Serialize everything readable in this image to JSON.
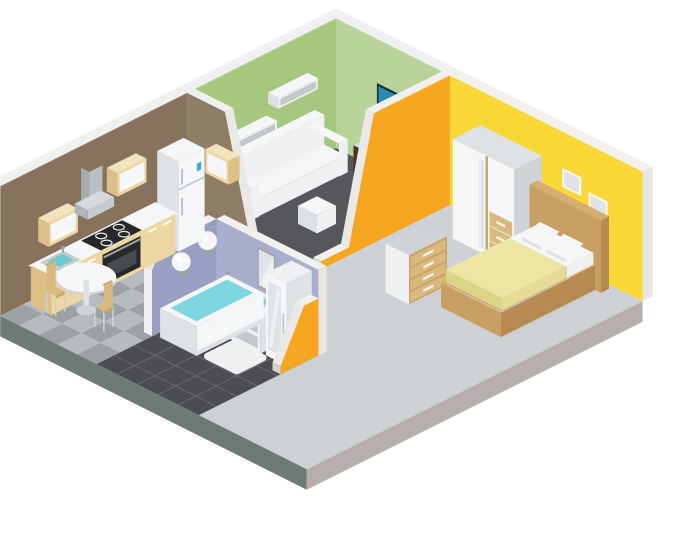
{
  "title": "Isometric cutaway illustration of a one-bedroom apartment with kitchen, living room, bedroom and bathroom",
  "rooms": [
    {
      "name": "kitchen",
      "wall_color": "#87725e",
      "floor_color": "#9ba1a5",
      "furniture": [
        "wall cabinets",
        "range hood",
        "cooktop",
        "oven",
        "kitchen sink",
        "refrigerator",
        "counter cabinets",
        "round dining table",
        "two chairs"
      ]
    },
    {
      "name": "living-room",
      "wall_color": "#a5c77e",
      "floor_color": "#56575a",
      "furniture": [
        "two wall shelves",
        "sofa",
        "wall tv",
        "media console",
        "table lamp",
        "ottoman"
      ]
    },
    {
      "name": "bedroom",
      "wall_color": "#f9d835",
      "floor_color": "#ced1d4",
      "furniture": [
        "wardrobe",
        "chest of drawers",
        "double bed",
        "two wall pictures"
      ]
    },
    {
      "name": "bathroom",
      "wall_color": "#a9aecc",
      "floor_color": "#4b4d50",
      "furniture": [
        "bathtub",
        "two wall lamps",
        "wall mirror",
        "sink vanity",
        "tall mirrored cabinet",
        "bath mat"
      ]
    }
  ],
  "palette": {
    "background": "#ffffff",
    "wallTrim": "#f1f0ee",
    "wallCapLight": "#e8e7e4",
    "wallCapShade": "#d4d3d0",
    "slopeCap": "#eae9e6",
    "livingWallLeft": "#a5c77e",
    "livingWallRight": "#b7d399",
    "bedroomWall": "#f9d835",
    "bedroomDivider": "#f6a71f",
    "kitchenWall": "#87725e",
    "kitchenDivider": "#8f7d68",
    "bathWallLeft": "#989fc2",
    "bathWallBack": "#a9aecc",
    "carpet": "#56575a",
    "kitchenTileA": "#9ba1a5",
    "kitchenTileB": "#b5bbbe",
    "bathFloor": "#4b4d50",
    "bathGrout": "#686a6e",
    "bedroomFloor": "#ced1d4",
    "slabLeft": "#6e7a75",
    "slabRight": "#b6afab",
    "whiteTop": "#f5f6f7",
    "whiteFront": "#eef0f2",
    "whiteSide": "#dfe2e5",
    "whiteShade": "#cfd3d6",
    "recess": "#c2c7ca",
    "cream": "#ecd7a2",
    "creamTop": "#f2e4ba",
    "creamShade": "#dcc088",
    "tan": "#d9b97e",
    "tanShade": "#c9a568",
    "wood": "#c89f63",
    "woodTop": "#d6ad72",
    "woodShade": "#b68a50",
    "darkBrown": "#4a3628",
    "tvFrame": "#14323e",
    "tvScreen": "#2b8cb0",
    "tvScreenShade": "#1f7394",
    "displayTeal": "#33b1c8",
    "water": "#7ed7e0",
    "sinkWater": "#6fc9d6",
    "steel": "#c6cbce",
    "steelShade": "#aeb4b8",
    "black": "#26282a",
    "ovenWindow": "#474b4d",
    "blanket": "#ece5a3",
    "blanketFront": "#dcd489",
    "blanketSide": "#e4dc96",
    "grayMetal": "#9aa0a3",
    "mirror": "#dfe3e6",
    "sheen": "#f2f5f6",
    "mat": "#eef0f1",
    "lampShade": "#3f2d1f",
    "consoleTop": "#dadde0"
  }
}
